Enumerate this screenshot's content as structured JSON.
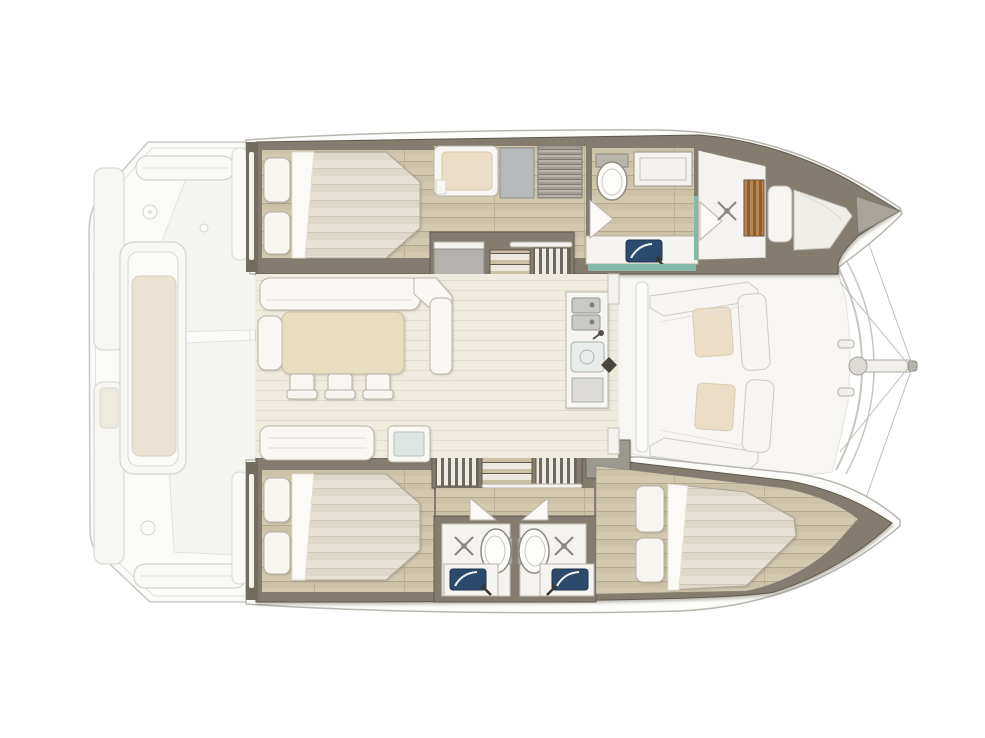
{
  "canvas": {
    "width": 985,
    "height": 738
  },
  "diagram_type": "catamaran-interior-floor-plan",
  "palette": {
    "background": "#ffffff",
    "hull_fill": "#fcfcfa",
    "hull_stroke": "#b9b6af",
    "wall": "#847d6f",
    "wall_edge": "#5f5a50",
    "wood_floor_base": "#cbc2a8",
    "saloon_floor": "#f0ebdf",
    "mattress_light": "#e7e2d4",
    "mattress_dark": "#ded8c8",
    "pillow": "#f7f5ef",
    "furniture_white": "#f8f7f3",
    "furniture_stroke": "#b5b1a7",
    "table_beige": "#e7ddc1",
    "cushion_beige": "#eadfc6",
    "deck_cushion": "#ebe3d1",
    "teal_glass": "#86b7ab",
    "teal_pale": "#dde6e3",
    "sink_navy": "#2c4a6b",
    "steel": "#c9c9c6",
    "slat_light": "#b9874f",
    "slat_dark": "#8a5f3a",
    "stair_stripe": "#6d6961",
    "locker_gray": "#b3b2ae",
    "locker_dark": "#9b988f",
    "faded_stroke": "#c9c8c4",
    "faded_fill": "#fafaf8",
    "shower_floor": "#f4f3ef",
    "x_mark": "#8a8781",
    "bow_cap": "#a8a49c"
  },
  "icons": {
    "shower_head": "x-cross-with-center-dot",
    "toilet": "oval-bowl-with-tank",
    "bathroom_sink": "navy-rounded-rect-with-faucet-arm",
    "galley_sink": "steel-square-with-drain-circle",
    "mast_step": "dark-diamond",
    "stairs_straight": "horizontal-tread-bars",
    "stairs_curved": "vertical-stripe-fan",
    "door_swing": "outline-triangle",
    "slatted_bench": "vertical-teak-slats",
    "bowsprit": "pole-with-ring-fitting",
    "rigging": "thin-bridle-lines"
  },
  "fixture_counts": {
    "double_beds": 3,
    "bow_berths": 1,
    "pillows": 6,
    "toilets": 3,
    "showers": 3,
    "bathroom_sinks": 3,
    "galley_sink_bowls": 3,
    "dining_chairs": 3,
    "dining_tables": 1,
    "sofas": 3,
    "stairways": 4,
    "aft_deck_benches": 2,
    "deck_lounges": 1
  }
}
